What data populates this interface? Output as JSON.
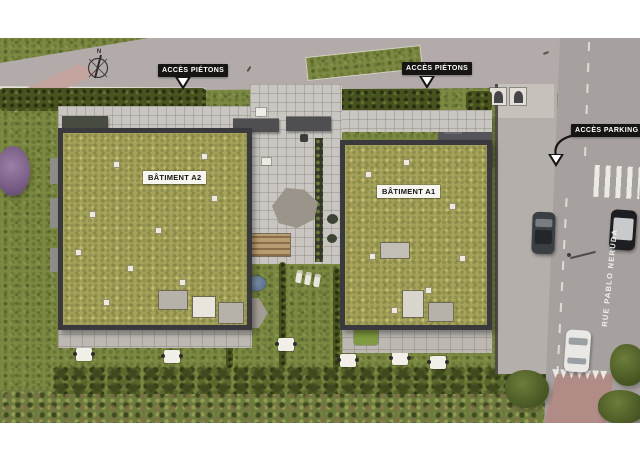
{
  "plan": {
    "compass": {
      "north": "N"
    },
    "markers": {
      "pietons_west": {
        "text": "ACCÈS PIÉTONS"
      },
      "pietons_east": {
        "text": "ACCÈS PIÉTONS"
      },
      "parking": {
        "text": "ACCÈS PARKING"
      }
    },
    "buildings": {
      "a2": {
        "label": "BÂTIMENT A2"
      },
      "a1": {
        "label": "BÂTIMENT A1"
      }
    },
    "street": {
      "name": "RUE PABLO NERUDA"
    },
    "colors": {
      "background": "#ffffff",
      "sidewalk": "#b2abaa",
      "road": "#a6a19e",
      "grass": "#7b8942",
      "hedge": "#47521f",
      "green_roof": "#a8a35b",
      "parapet": "#3a3a3e",
      "paving": "#c9c6c1",
      "marker_bg": "#171513",
      "marker_text": "#ffffff",
      "red_paving": "#b18c86",
      "pink_path": "#c3a49e"
    }
  }
}
